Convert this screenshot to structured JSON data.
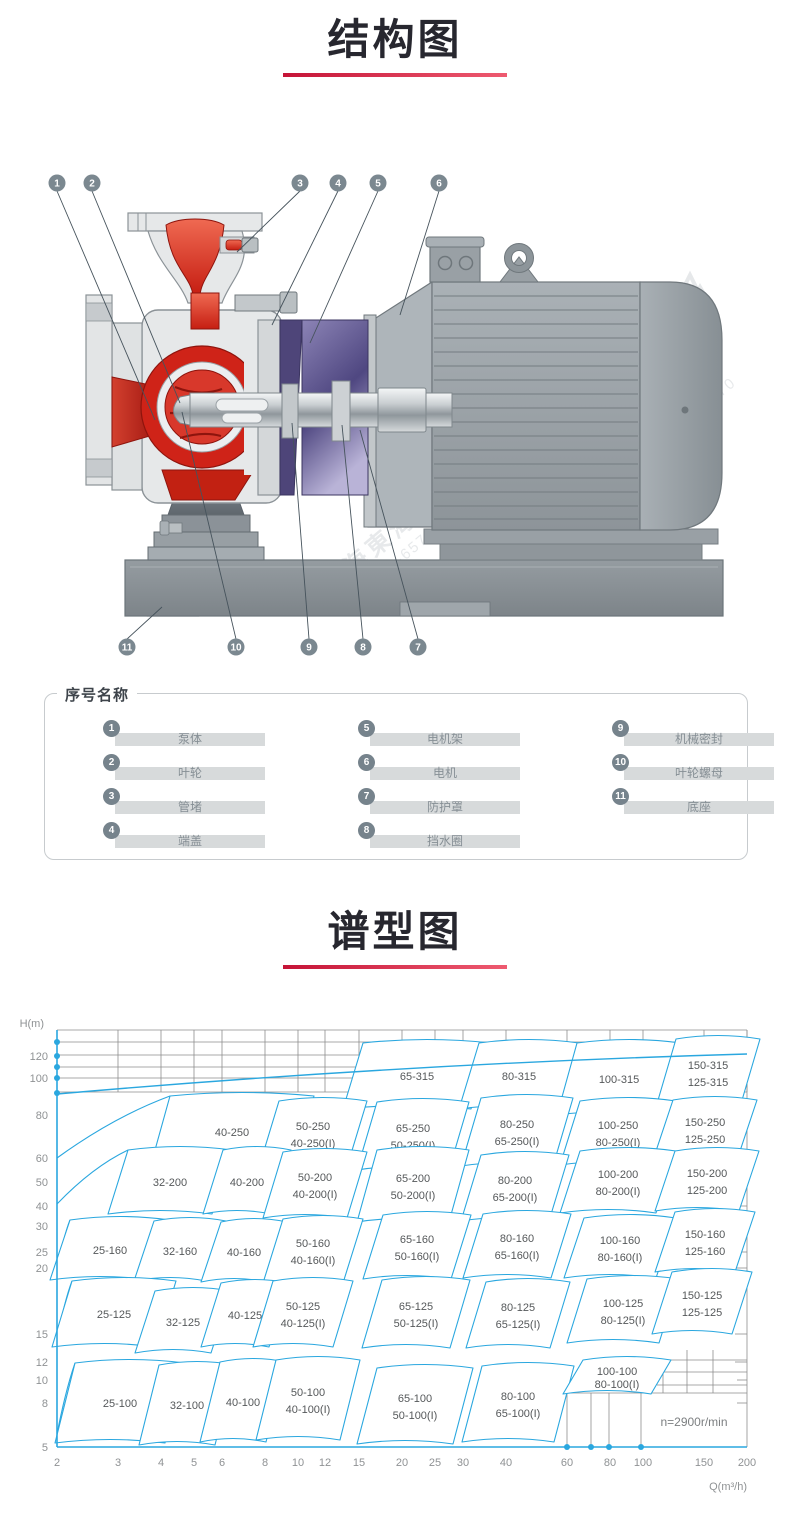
{
  "sections": {
    "structure": {
      "title": "结构图"
    },
    "spectrum": {
      "title": "谱型图"
    }
  },
  "watermark": {
    "brand": "上海東海",
    "phone": "800-820-6570"
  },
  "legend": {
    "title": "序号名称",
    "items": [
      {
        "no": "1",
        "name": "泵体"
      },
      {
        "no": "2",
        "name": "叶轮"
      },
      {
        "no": "3",
        "name": "管堵"
      },
      {
        "no": "4",
        "name": "端盖"
      },
      {
        "no": "5",
        "name": "电机架"
      },
      {
        "no": "6",
        "name": "电机"
      },
      {
        "no": "7",
        "name": "防护罩"
      },
      {
        "no": "8",
        "name": "挡水圈"
      },
      {
        "no": "9",
        "name": "机械密封"
      },
      {
        "no": "10",
        "name": "叶轮螺母"
      },
      {
        "no": "11",
        "name": "底座"
      }
    ],
    "columns": [
      [
        0,
        1,
        2,
        3
      ],
      [
        4,
        5,
        6,
        7
      ],
      [
        8,
        9,
        10
      ]
    ]
  },
  "diagram": {
    "callouts": [
      {
        "no": "1",
        "cx": 27,
        "cy": 28,
        "tx": 125,
        "ty": 265
      },
      {
        "no": "2",
        "cx": 62,
        "cy": 28,
        "tx": 150,
        "ty": 248
      },
      {
        "no": "3",
        "cx": 270,
        "cy": 28,
        "tx": 207,
        "ty": 97
      },
      {
        "no": "4",
        "cx": 308,
        "cy": 28,
        "tx": 242,
        "ty": 170
      },
      {
        "no": "5",
        "cx": 348,
        "cy": 28,
        "tx": 280,
        "ty": 188
      },
      {
        "no": "6",
        "cx": 409,
        "cy": 28,
        "tx": 370,
        "ty": 160
      },
      {
        "no": "11",
        "cx": 97,
        "cy": 492,
        "tx": 132,
        "ty": 452
      },
      {
        "no": "10",
        "cx": 206,
        "cy": 492,
        "tx": 152,
        "ty": 257
      },
      {
        "no": "9",
        "cx": 279,
        "cy": 492,
        "tx": 262,
        "ty": 268
      },
      {
        "no": "8",
        "cx": 333,
        "cy": 492,
        "tx": 312,
        "ty": 270
      },
      {
        "no": "7",
        "cx": 388,
        "cy": 492,
        "tx": 330,
        "ty": 275
      }
    ]
  },
  "chart_data": {
    "type": "area",
    "title": "谱型图",
    "xlabel": "Q(m³/h)",
    "ylabel": "H(m)",
    "x_scale": "log",
    "y_scale": "log",
    "xlim": [
      2,
      200
    ],
    "ylim": [
      5,
      140
    ],
    "grid": "partial",
    "annotation": "n=2900r/min",
    "x_ticks": [
      2,
      3,
      4,
      5,
      6,
      8,
      10,
      12,
      15,
      20,
      25,
      30,
      40,
      60,
      80,
      100,
      150,
      200
    ],
    "y_ticks": [
      120,
      100,
      80,
      60,
      50,
      40,
      30,
      25,
      20,
      15,
      12,
      10,
      8,
      5
    ],
    "colors": {
      "curve": "#2AA7DF",
      "grid": "#8d8d8d",
      "tick_text": "#8f9294",
      "region_text": "#55585a"
    },
    "regions": [
      {
        "labels": [
          "65-315"
        ],
        "q": 22,
        "h": 99,
        "px": [
          417,
          66,
          64,
          33
        ]
      },
      {
        "labels": [
          "80-315"
        ],
        "q": 44,
        "h": 99,
        "px": [
          519,
          66,
          50,
          33
        ]
      },
      {
        "labels": [
          "100-315"
        ],
        "q": 85,
        "h": 97,
        "px": [
          619,
          69,
          52,
          36
        ]
      },
      {
        "labels": [
          "150-315",
          "125-315"
        ],
        "q": 154,
        "h": 102,
        "px": [
          708,
          63,
          42,
          34
        ]
      },
      {
        "labels": [
          "40-250"
        ],
        "q": 6.4,
        "h": 63,
        "px": [
          232,
          122,
          72,
          36
        ],
        "tail": 148
      },
      {
        "labels": [
          "50-250",
          "40-250(I)"
        ],
        "q": 11,
        "h": 62,
        "px": [
          313,
          124,
          44,
          33
        ]
      },
      {
        "labels": [
          "65-250",
          "50-250(I)"
        ],
        "q": 21.5,
        "h": 61,
        "px": [
          413,
          126,
          46,
          34
        ]
      },
      {
        "labels": [
          "80-250",
          "65-250(I)"
        ],
        "q": 43,
        "h": 63,
        "px": [
          517,
          122,
          46,
          34
        ]
      },
      {
        "labels": [
          "100-250",
          "80-250(I)"
        ],
        "q": 85,
        "h": 63,
        "px": [
          618,
          123,
          48,
          32
        ]
      },
      {
        "labels": [
          "150-250",
          "125-250"
        ],
        "q": 151,
        "h": 64,
        "px": [
          705,
          120,
          42,
          30
        ]
      },
      {
        "labels": [
          "32-200"
        ],
        "q": 4.3,
        "h": 42,
        "px": [
          170,
          172,
          52,
          32
        ],
        "tail": 194
      },
      {
        "labels": [
          "40-200"
        ],
        "q": 7.1,
        "h": 42,
        "px": [
          247,
          172,
          34,
          32
        ]
      },
      {
        "labels": [
          "50-200",
          "40-200(I)"
        ],
        "q": 11,
        "h": 41,
        "px": [
          315,
          175,
          42,
          33
        ]
      },
      {
        "labels": [
          "65-200",
          "50-200(I)"
        ],
        "q": 21.5,
        "h": 41,
        "px": [
          413,
          176,
          46,
          36
        ]
      },
      {
        "labels": [
          "80-200",
          "65-200(I)"
        ],
        "q": 42.5,
        "h": 40,
        "px": [
          515,
          178,
          44,
          33
        ]
      },
      {
        "labels": [
          "100-200",
          "80-200(I)"
        ],
        "q": 85,
        "h": 42,
        "px": [
          618,
          172,
          48,
          31
        ]
      },
      {
        "labels": [
          "150-200",
          "125-200"
        ],
        "q": 153,
        "h": 42.5,
        "px": [
          707,
          171,
          42,
          30
        ]
      },
      {
        "labels": [
          "25-160"
        ],
        "q": 2.9,
        "h": 24,
        "px": [
          110,
          240,
          50,
          30
        ],
        "tail": 262
      },
      {
        "labels": [
          "32-160"
        ],
        "q": 4.6,
        "h": 24,
        "px": [
          180,
          241,
          36,
          30
        ]
      },
      {
        "labels": [
          "40-160"
        ],
        "q": 7,
        "h": 24,
        "px": [
          244,
          242,
          33,
          30
        ]
      },
      {
        "labels": [
          "50-160",
          "40-160(I)"
        ],
        "q": 11,
        "h": 24,
        "px": [
          313,
          241,
          40,
          32
        ]
      },
      {
        "labels": [
          "65-160",
          "50-160(I)"
        ],
        "q": 22,
        "h": 25,
        "px": [
          417,
          237,
          44,
          32
        ]
      },
      {
        "labels": [
          "80-160",
          "65-160(I)"
        ],
        "q": 43,
        "h": 25,
        "px": [
          517,
          236,
          44,
          32
        ]
      },
      {
        "labels": [
          "100-160",
          "80-160(I)"
        ],
        "q": 86,
        "h": 25,
        "px": [
          620,
          238,
          46,
          30
        ]
      },
      {
        "labels": [
          "150-160",
          "125-160"
        ],
        "q": 151,
        "h": 26,
        "px": [
          705,
          232,
          40,
          30
        ]
      },
      {
        "labels": [
          "25-125"
        ],
        "q": 2.9,
        "h": 14.6,
        "px": [
          114,
          304,
          52,
          33
        ],
        "tail": 330
      },
      {
        "labels": [
          "32-125"
        ],
        "q": 4.6,
        "h": 13.7,
        "px": [
          183,
          312,
          38,
          31
        ]
      },
      {
        "labels": [
          "40-125"
        ],
        "q": 7,
        "h": 14.5,
        "px": [
          245,
          305,
          34,
          32
        ]
      },
      {
        "labels": [
          "50-125",
          "40-125(I)"
        ],
        "q": 10.3,
        "h": 14.6,
        "px": [
          303,
          304,
          40,
          33
        ]
      },
      {
        "labels": [
          "65-125",
          "50-125(I)"
        ],
        "q": 22,
        "h": 14.6,
        "px": [
          416,
          304,
          44,
          34
        ]
      },
      {
        "labels": [
          "80-125",
          "65-125(I)"
        ],
        "q": 43,
        "h": 14.5,
        "px": [
          518,
          305,
          42,
          33
        ]
      },
      {
        "labels": [
          "100-125",
          "80-125(I)"
        ],
        "q": 87,
        "h": 14.9,
        "px": [
          623,
          301,
          46,
          32
        ]
      },
      {
        "labels": [
          "150-125",
          "125-125"
        ],
        "q": 148,
        "h": 15.9,
        "px": [
          702,
          293,
          40,
          31
        ]
      },
      {
        "labels": [
          "25-100"
        ],
        "q": 3,
        "h": 7.1,
        "px": [
          120,
          393,
          55,
          40
        ],
        "tail": 424
      },
      {
        "labels": [
          "32-100"
        ],
        "q": 4.8,
        "h": 7,
        "px": [
          187,
          395,
          38,
          40
        ]
      },
      {
        "labels": [
          "40-100"
        ],
        "q": 7,
        "h": 7.2,
        "px": [
          243,
          392,
          33,
          40
        ]
      },
      {
        "labels": [
          "50-100",
          "40-100(I)"
        ],
        "q": 10.7,
        "h": 7.3,
        "px": [
          308,
          390,
          42,
          40
        ]
      },
      {
        "labels": [
          "65-100",
          "50-100(I)"
        ],
        "q": 22,
        "h": 7,
        "px": [
          415,
          396,
          48,
          38
        ]
      },
      {
        "labels": [
          "80-100",
          "65-100(I)"
        ],
        "q": 43,
        "h": 7.1,
        "px": [
          518,
          394,
          46,
          38
        ]
      },
      {
        "labels": [
          "100-100",
          "80-100(I)"
        ],
        "q": 84,
        "h": 8.8,
        "px": [
          617,
          367,
          44,
          17
        ]
      }
    ],
    "layout": {
      "plot": {
        "left": 57,
        "right": 747,
        "top": 20,
        "bottom": 437
      },
      "x_tick_px": [
        57,
        118,
        161,
        194,
        222,
        265,
        298,
        325,
        359,
        402,
        435,
        463,
        506,
        567,
        610,
        643,
        704,
        747
      ],
      "y_tick_px": [
        46,
        68,
        105,
        148,
        172,
        196,
        216,
        242,
        258,
        324,
        352,
        370,
        393,
        437
      ],
      "top_h_px": [
        32,
        45,
        57,
        68,
        82
      ],
      "band_bottom": 82,
      "top_curve": "M57,84 Q400,54 747,44",
      "extra_h": [
        [
          657,
          747,
          350
        ],
        [
          657,
          747,
          362
        ],
        [
          657,
          747,
          375
        ],
        [
          567,
          747,
          383
        ],
        [
          735,
          747,
          100
        ],
        [
          735,
          747,
          148
        ],
        [
          735,
          747,
          172
        ],
        [
          735,
          747,
          196
        ],
        [
          735,
          747,
          216
        ],
        [
          735,
          747,
          242
        ],
        [
          735,
          747,
          258
        ],
        [
          735,
          747,
          324
        ],
        [
          735,
          747,
          352
        ],
        [
          737,
          747,
          370
        ],
        [
          737,
          747,
          393
        ]
      ],
      "extra_v": [
        [
          687,
          340,
          383
        ],
        [
          713,
          340,
          383
        ],
        [
          663,
          350,
          383
        ],
        [
          567,
          383,
          437
        ],
        [
          591,
          383,
          437
        ],
        [
          609,
          383,
          437
        ],
        [
          641,
          383,
          437
        ]
      ],
      "dots_y": [
        32,
        46,
        57,
        68,
        83
      ],
      "dots_x": [
        567,
        591,
        609,
        641
      ]
    }
  }
}
